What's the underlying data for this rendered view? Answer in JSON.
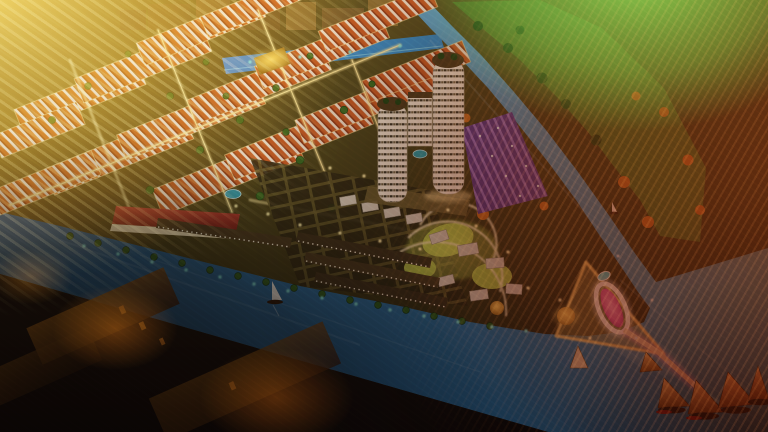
{
  "meta": {
    "title": "Aerial night rendering of a riverside township master plan",
    "type": "architectural marketing render",
    "view": "high-angle aerial, night scene with lens flares",
    "no_visible_text": true
  },
  "palette": {
    "gold_flare": "#ffcf4f",
    "green_glow": "#3ec23e",
    "red_flare": "#962c0c",
    "water_deep": "#17456e",
    "water_mid": "#2e72a8",
    "water_light": "#7fc0e0",
    "canal": "#3584c4",
    "land": "#3c3414",
    "land_lit": "#6b5a24",
    "road_glow": "#ffe89a",
    "roof_orange": "#c05420",
    "roof_stripe": "#ecdcc8",
    "roof_red": "#a02820",
    "tower": "#ece5d6",
    "tower_cap": "#4a3418",
    "purple_deep": "#5a3390",
    "purple_light": "#9a6fd0",
    "magenta": "#e055a8",
    "teal": "#7fe8de",
    "lawn": "#b6cf4a",
    "tree": "#35611c",
    "tree_dark": "#1e3c10",
    "tree_orange": "#c06a1c",
    "sail_gold": "#e0b050",
    "hull": "#2c1406",
    "boat_white": "#f4f0e6",
    "town_amber": "#9a5410",
    "city_haze": "#7d5c28"
  },
  "scene": {
    "water_bodies": [
      "top boundary canal",
      "winding east river",
      "wide south-west river bay"
    ],
    "districts": {
      "shophouse_rows": {
        "count": 15,
        "roof_style": "orange with cream stripes",
        "lighting": "yellow street glow"
      },
      "villa_grid": {
        "style": "dark plots with glowing road grid and fan-shaped lawns near the point"
      },
      "townhouse_rows": {
        "count": 3,
        "style": "brown roofs, white lit facades along waterfront"
      },
      "purple_market": {
        "style": "rows lit in violet beside the east river"
      },
      "waterfront_strip": {
        "style": "long red-roofed building with lit white facade"
      }
    },
    "towers": {
      "count": 2,
      "style": "white cylindrical high-rises with lit window bands",
      "extra": "mid-rise block and teal pool between"
    },
    "landmark_point": {
      "ring_monument": "white oval ring lit magenta",
      "pool": "teal oval",
      "plaza": "gold-lit triangular promenade",
      "pier": "pink-lit pier to marina"
    },
    "boats": {
      "white_sailboats": 2,
      "gold_sail_boats": 5,
      "beach_sail": 1
    },
    "background_city": "hazy gold mid-rise skyline behind the canal",
    "effects": [
      "golden sun flare upper-left with diagonal rays",
      "green glow upper-right",
      "deep red flare across right edge",
      "fine diagonal light streak texture"
    ]
  }
}
